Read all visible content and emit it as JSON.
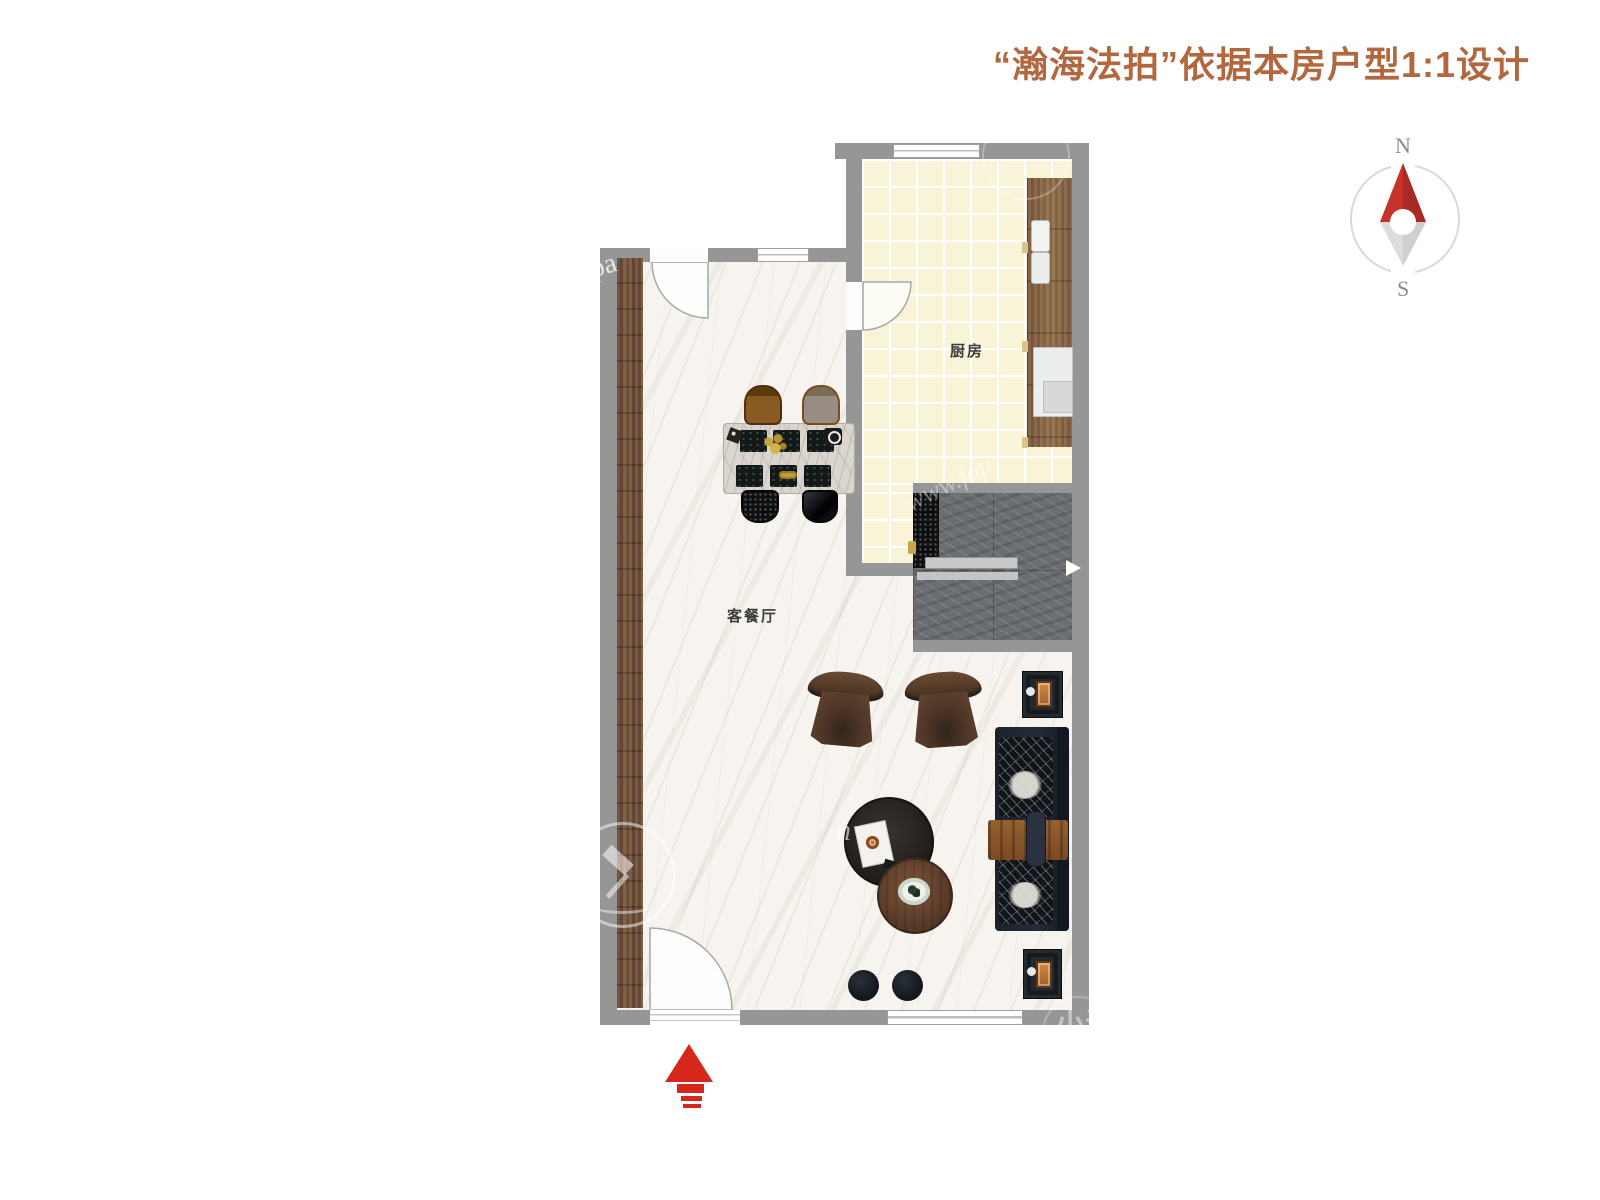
{
  "header": {
    "title": "“瀚海法拍”依据本房户型1:1设计",
    "title_color": "#b2673e"
  },
  "compass": {
    "north": "N",
    "south": "S",
    "needle_red": "#c5332b",
    "needle_gray": "#d9d9d9",
    "ring_color": "#d9d9d9"
  },
  "floor_plan": {
    "rooms": [
      {
        "id": "kitchen",
        "label": "厨房"
      },
      {
        "id": "living_dining",
        "label": "客餐厅"
      }
    ],
    "wall_color": "#969696",
    "kitchen_tile_color": "#f9f4d8",
    "living_floor_color": "#f7f4ef",
    "stairs_marble_color": "#6b6e71",
    "wood_panel_color": "#745138",
    "entrance_arrow_color": "#d7261c"
  },
  "watermarks": {
    "wm_left_wall": "apa",
    "wm_stairs": "www.fap",
    "wm_bottom_right": "小海",
    "wm_floor_letter": "n"
  }
}
